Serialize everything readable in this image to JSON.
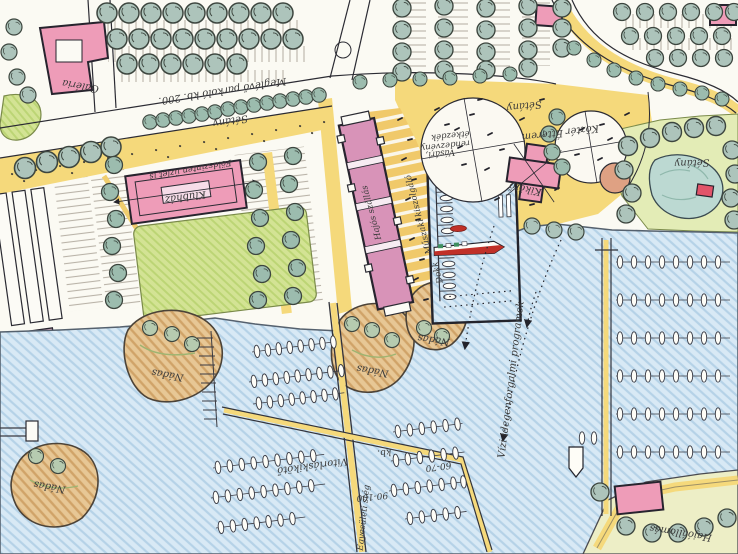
{
  "labels": {
    "galeria": "Galéria",
    "parkolo": "Meglévő parkoló kb. 200.",
    "setany": "Sétány",
    "klubhaz": "Klubház",
    "uzlet": "Földszinten üzlet is",
    "hajos_szallas": "Hajós szállás",
    "muszaki": "Műszaki kiszolgáló",
    "dokk": "Dokk",
    "kozter": "Köztér",
    "vasari": "Vásári,",
    "rendezveny": "rendezvény",
    "etkezdek": "étkezdék",
    "etterem": "Étterem",
    "kikoto": "Kikötő",
    "vizi_programok": "Vízi idegenforgalmi programok",
    "nadas": "Nádas",
    "vitorlaskikoto": "Vitorláskikötő",
    "kb": "kb.",
    "n60_70": "60-70",
    "n90_100": "90-100",
    "egyesuleti_steg": "Egyesületi stég",
    "hajoallomas": "Hajóállomás"
  },
  "palette": {
    "water": "#d8e9f5",
    "water_hatch": "#b5d2e7",
    "building_pink": "#ee9cb8",
    "path_yellow": "#f5d97b",
    "dock_yellow": "#f0c96a",
    "lawn_green": "#d3e394",
    "tree_green": "#adc4bb",
    "island_sand": "#e7c795",
    "boat_red": "#c03028",
    "ink": "#2b2b33"
  }
}
